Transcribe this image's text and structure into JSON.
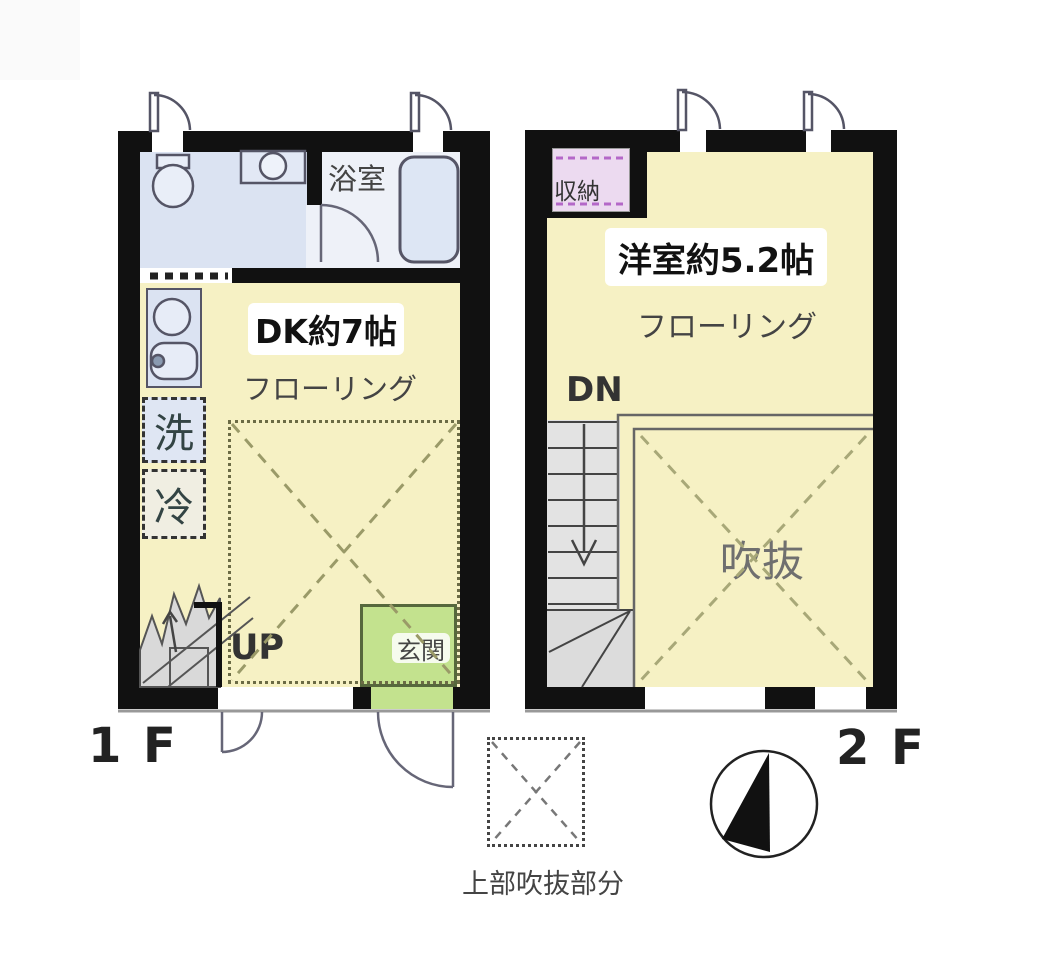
{
  "floor1": {
    "floor_label": "1F",
    "bathroom_label": "浴室",
    "dk_label": "DK約7帖",
    "flooring_label": "フローリング",
    "washer_label": "洗",
    "fridge_label": "冷",
    "up_label": "UP",
    "entrance_label": "玄関"
  },
  "floor2": {
    "floor_label": "2F",
    "storage_label": "収納",
    "room_label": "洋室約5.2帖",
    "flooring_label": "フローリング",
    "down_label": "DN",
    "void_label": "吹抜"
  },
  "legend": {
    "void_above_label": "上部吹抜部分"
  },
  "icons": {
    "compass": "north-arrow-compass",
    "toilet": "toilet-icon",
    "washbasin": "washbasin-icon",
    "bathtub": "bathtub-icon",
    "kitchen": "kitchen-sink-icon",
    "stairs_up": "stairs-up-icon",
    "stairs_down": "stairs-down-icon"
  },
  "colors": {
    "wall": "#111111",
    "room_yellow": "#f6f1c4",
    "water_blue": "#dbe3f2",
    "bath_floor": "#eef1f8",
    "entrance_green": "#c3e28e",
    "storage_lavender": "#ecdaf0",
    "stairs_gray": "#dcdcdc",
    "dash_olive": "#9a9a68"
  }
}
